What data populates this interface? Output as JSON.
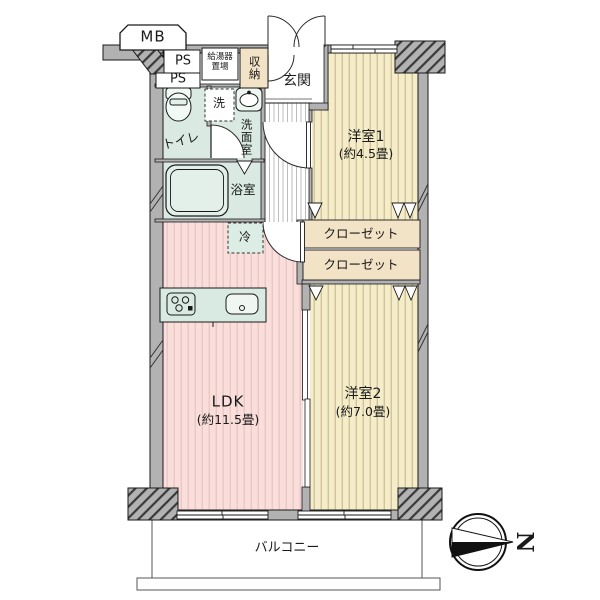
{
  "plan_type": "apartment-floor-plan",
  "labels": {
    "mb": "MB",
    "ps_top": "PS",
    "ps_bottom": "PS",
    "water_heater_line1": "給湯器",
    "water_heater_line2": "置場",
    "storage": "収納",
    "entrance": "玄関",
    "toilet": "トイレ",
    "washer": "洗",
    "washroom": "洗面室",
    "bathroom": "浴室",
    "fridge": "冷",
    "bedroom1_name": "洋室1",
    "bedroom1_size": "(約4.5畳)",
    "closet1": "クローゼット",
    "closet2": "クローゼット",
    "bedroom2_name": "洋室2",
    "bedroom2_size": "(約7.0畳)",
    "ldk_name": "LDK",
    "ldk_size": "(約11.5畳)",
    "balcony": "バルコニー",
    "north": "N"
  },
  "icons": {
    "compass": "compass-north-icon",
    "toilet": "toilet-icon",
    "bathtub": "bathtub-icon",
    "washbasin": "washbasin-icon",
    "stove": "stove-icon",
    "kitchen_sink": "kitchen-sink-icon"
  },
  "colors": {
    "wall_gray": "#b2b2b2",
    "line": "#1a1a1a",
    "ldk_pink": "#f9dedb",
    "ldk_pink_stripe": "#e9c5c2",
    "room_beige": "#f5edca",
    "room_beige_stripe": "#cfc094",
    "sanitary_mint": "#daeae2",
    "closet_tan": "#f2e2c6",
    "hallway_stripe": "#bdbdbd"
  }
}
